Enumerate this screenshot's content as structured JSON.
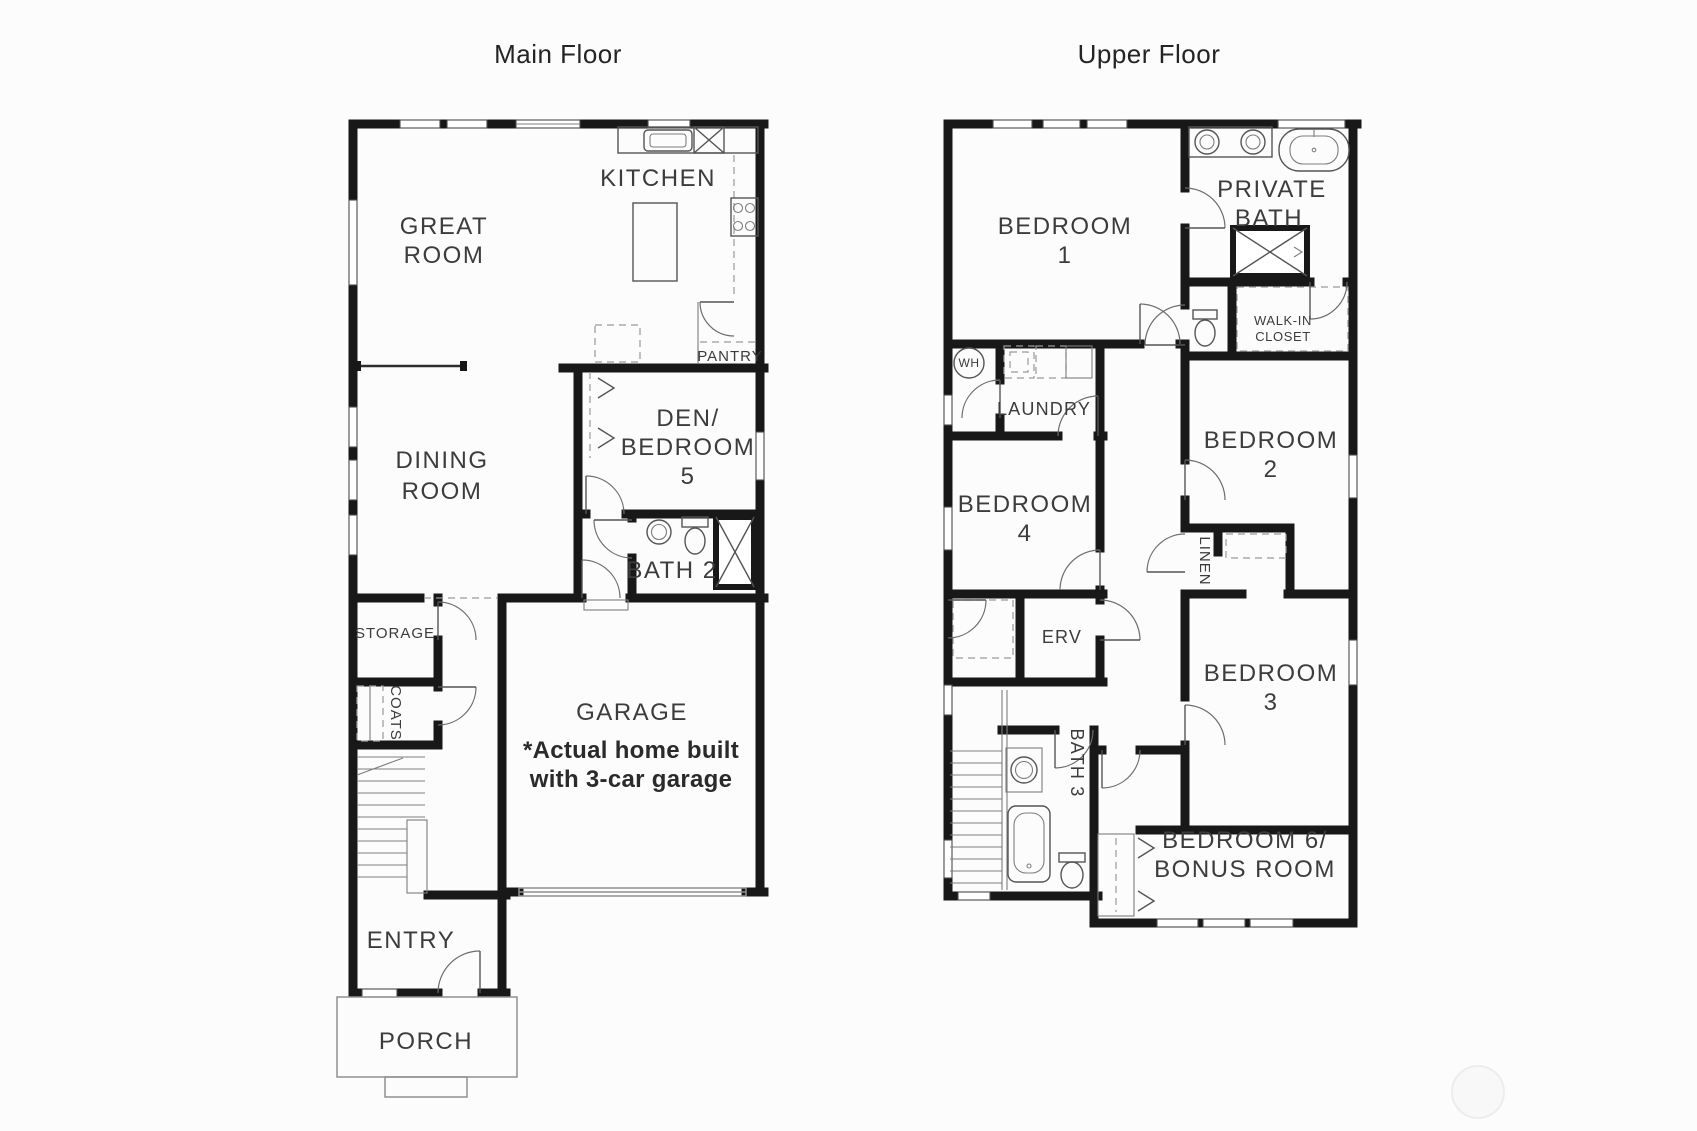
{
  "colors": {
    "walls": "#181818",
    "labels": "#3c3c3c",
    "background": "#fcfcfc"
  },
  "main_floor": {
    "title": "Main Floor",
    "rooms": {
      "great_room": [
        "GREAT",
        "ROOM"
      ],
      "kitchen": "KITCHEN",
      "pantry": "PANTRY",
      "dining_room": [
        "DINING",
        "ROOM"
      ],
      "den_bedroom_5": [
        "DEN/",
        "BEDROOM",
        "5"
      ],
      "bath_2": "BATH 2",
      "storage": "STORAGE",
      "coats": "COATS",
      "garage": "GARAGE",
      "entry": "ENTRY",
      "porch": "PORCH"
    },
    "garage_note": [
      "*Actual home built",
      "with 3-car garage"
    ]
  },
  "upper_floor": {
    "title": "Upper Floor",
    "rooms": {
      "bedroom_1": [
        "BEDROOM",
        "1"
      ],
      "private_bath": [
        "PRIVATE",
        "BATH"
      ],
      "walk_in_closet": [
        "WALK-IN",
        "CLOSET"
      ],
      "water_heater": "WH",
      "laundry": "LAUNDRY",
      "bedroom_4": [
        "BEDROOM",
        "4"
      ],
      "bedroom_2": [
        "BEDROOM",
        "2"
      ],
      "linen": "LINEN",
      "erv": "ERV",
      "bedroom_3": [
        "BEDROOM",
        "3"
      ],
      "bath_3": "BATH 3",
      "bedroom_6_bonus": [
        "BEDROOM 6/",
        "BONUS ROOM"
      ]
    }
  }
}
